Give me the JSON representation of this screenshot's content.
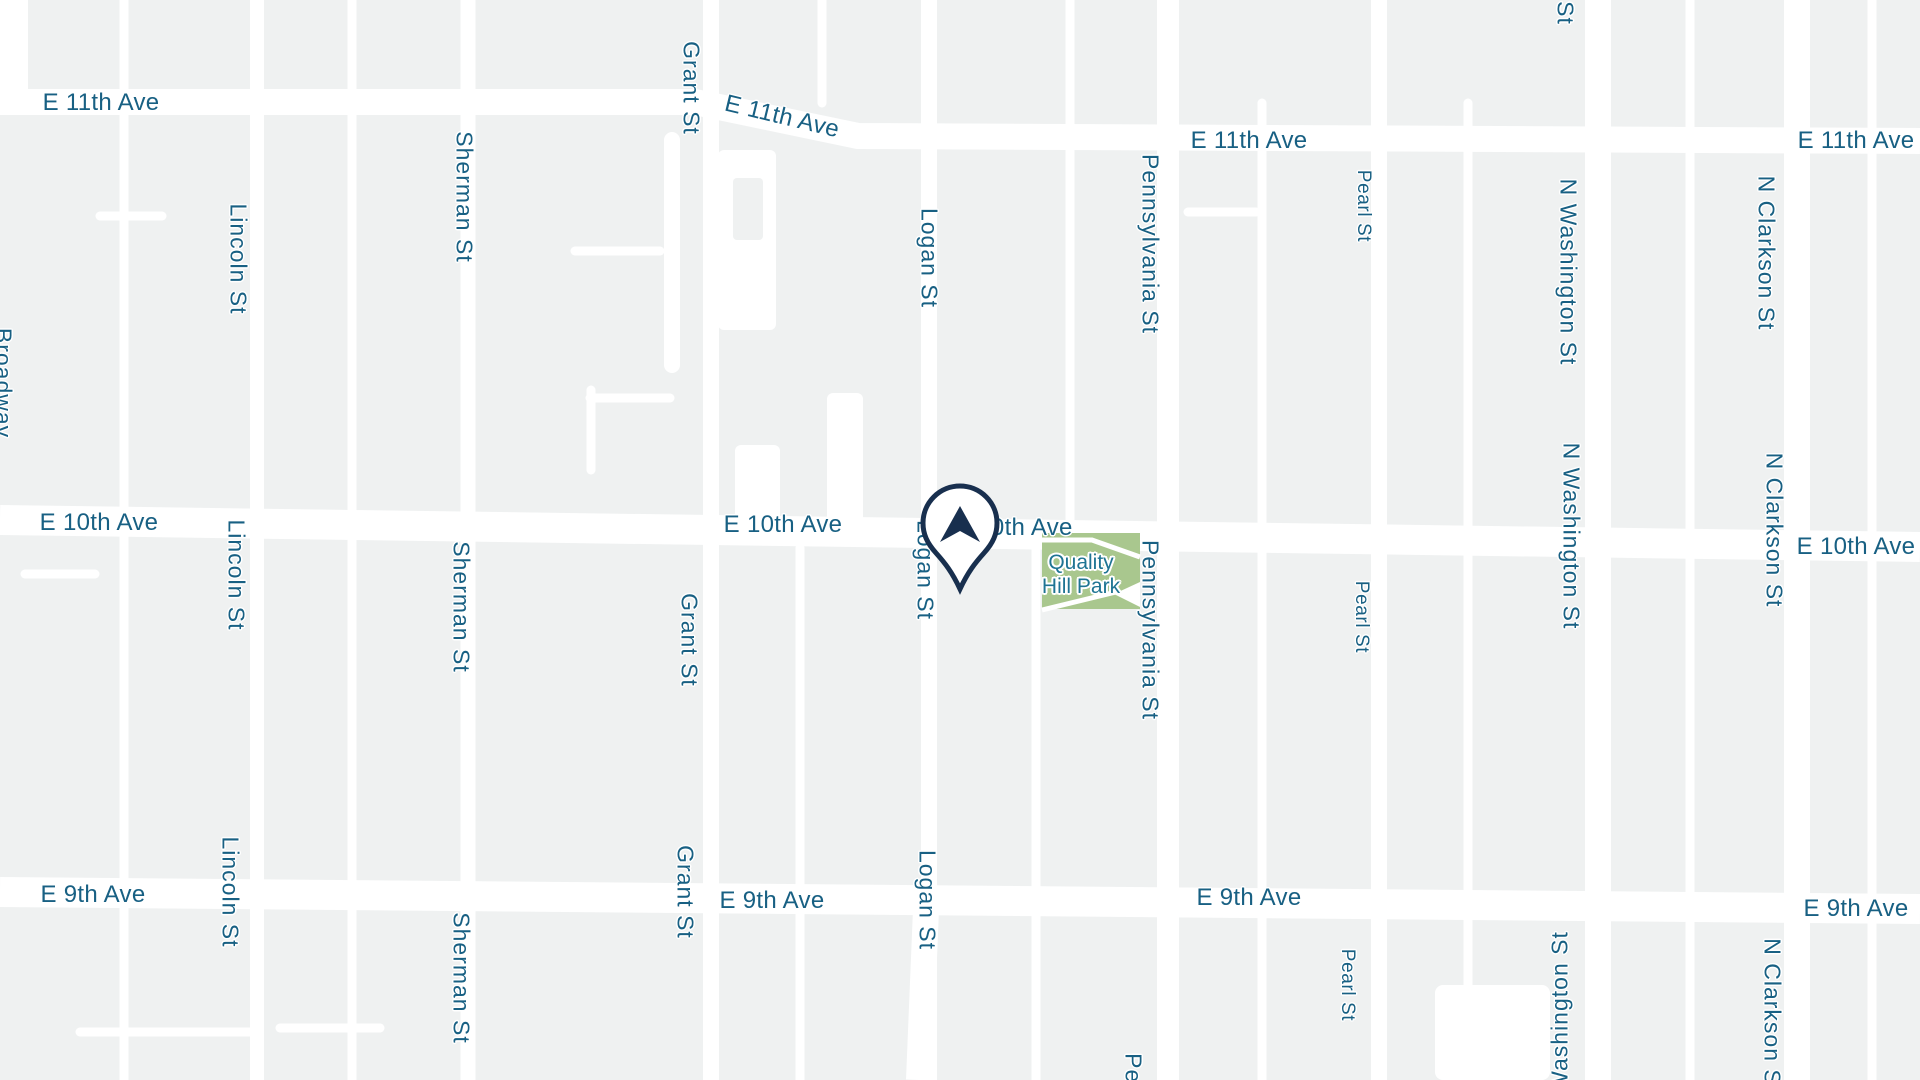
{
  "map": {
    "colors": {
      "road": "#ffffff",
      "block": "#eff1f1",
      "street_label": "#186083",
      "park_label": "#1e7493",
      "park_fill": "#a9c78e",
      "pin_outline": "#182f4e",
      "pin_fill": "#ffffff"
    },
    "avenues": {
      "e11th": "E 11th Ave",
      "e10th": "E 10th Ave",
      "e9th": "E 9th Ave"
    },
    "streets": {
      "broadway": "Broadway",
      "lincoln": "Lincoln St",
      "sherman": "Sherman St",
      "grant": "Grant St",
      "logan": "Logan St",
      "pennsylvania": "Pennsylvania St",
      "pearl": "Pearl St",
      "n_washington": "N Washington St",
      "n_clarkson": "N Clarkson St"
    },
    "fragments": {
      "st_top": "St",
      "penn_bottom": "Penn",
      "washington_bottom": "Washington St",
      "n_clarkson_bottom": "N Clarkson S"
    },
    "park": {
      "name": "Quality Hill Park",
      "line1": "Quality",
      "line2": "Hill Park"
    },
    "pin": {
      "icon": "location-pin-icon"
    }
  }
}
